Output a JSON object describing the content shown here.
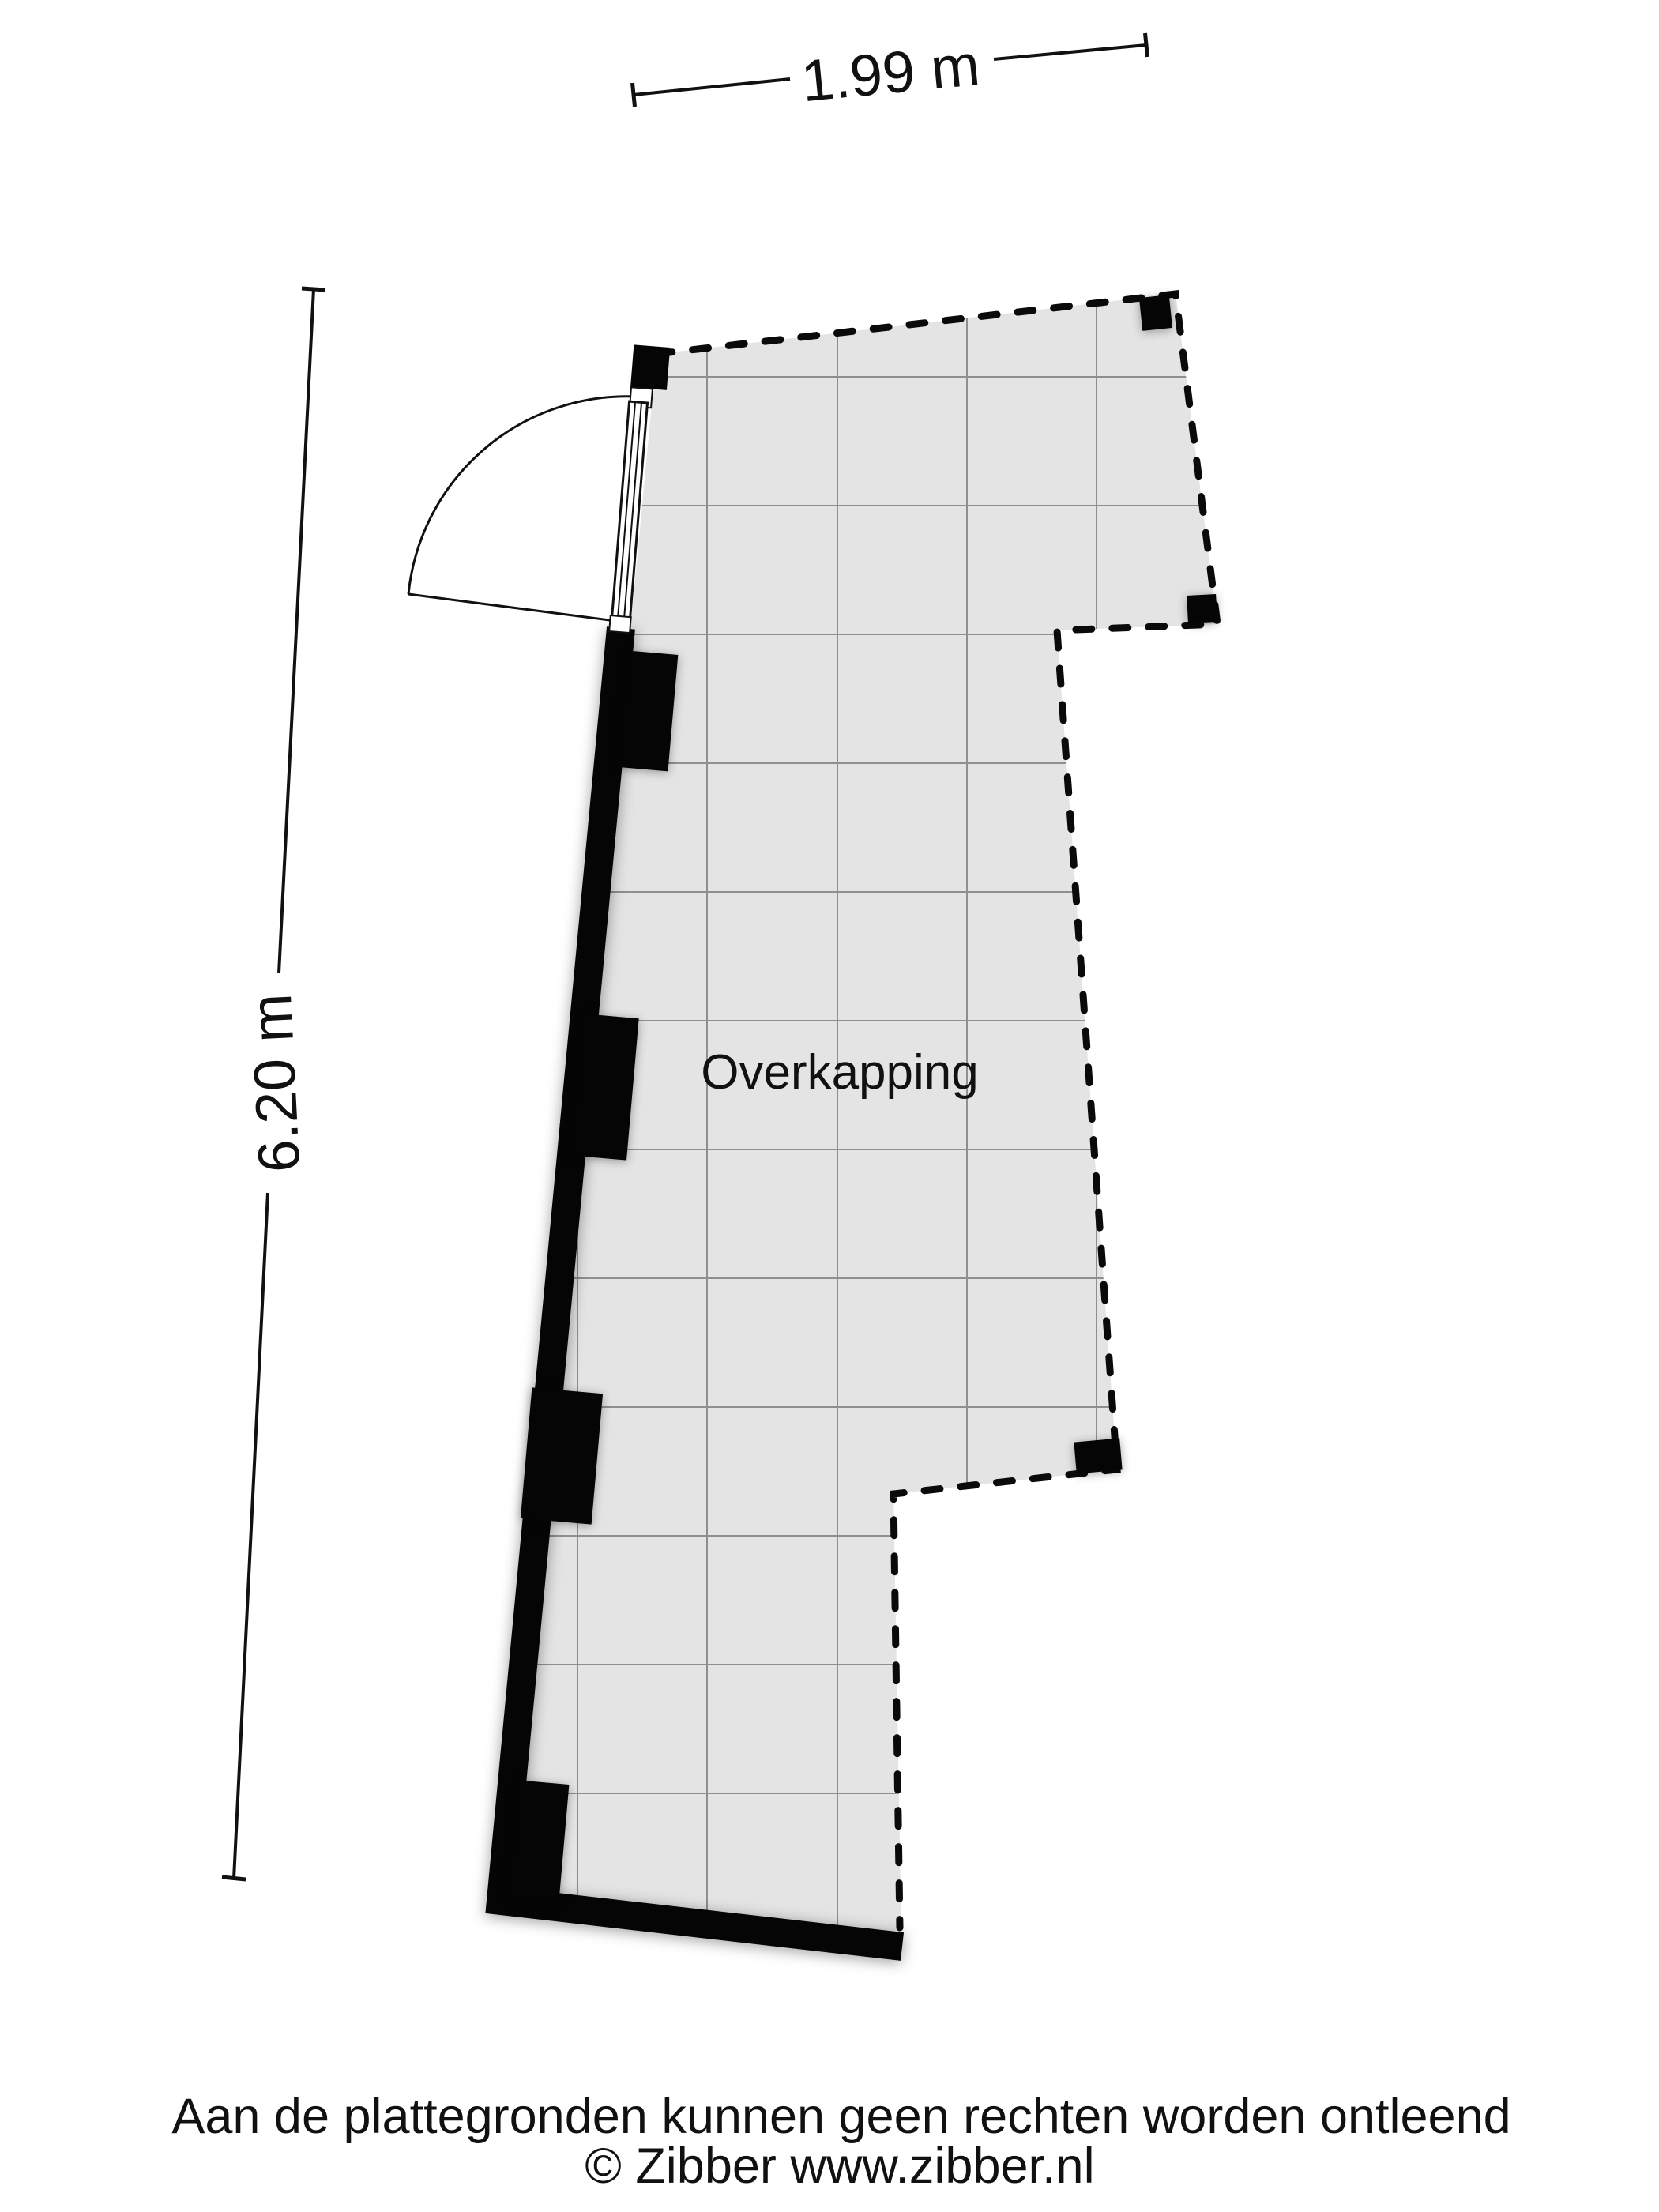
{
  "plan": {
    "room_label": "Overkapping"
  },
  "dimensions": {
    "width_label": "1.99 m",
    "height_label": "6.20 m"
  },
  "footer": {
    "disclaimer": "Aan de plattegronden kunnen geen rechten worden ontleend",
    "copyright": "© Zibber www.zibber.nl"
  },
  "colors": {
    "floor_fill": "#e4e4e4",
    "grid_line": "#8f8f8f",
    "boundary_dash": "#0a0a0a",
    "wall": "#050505",
    "text": "#111111",
    "background": "#ffffff"
  }
}
